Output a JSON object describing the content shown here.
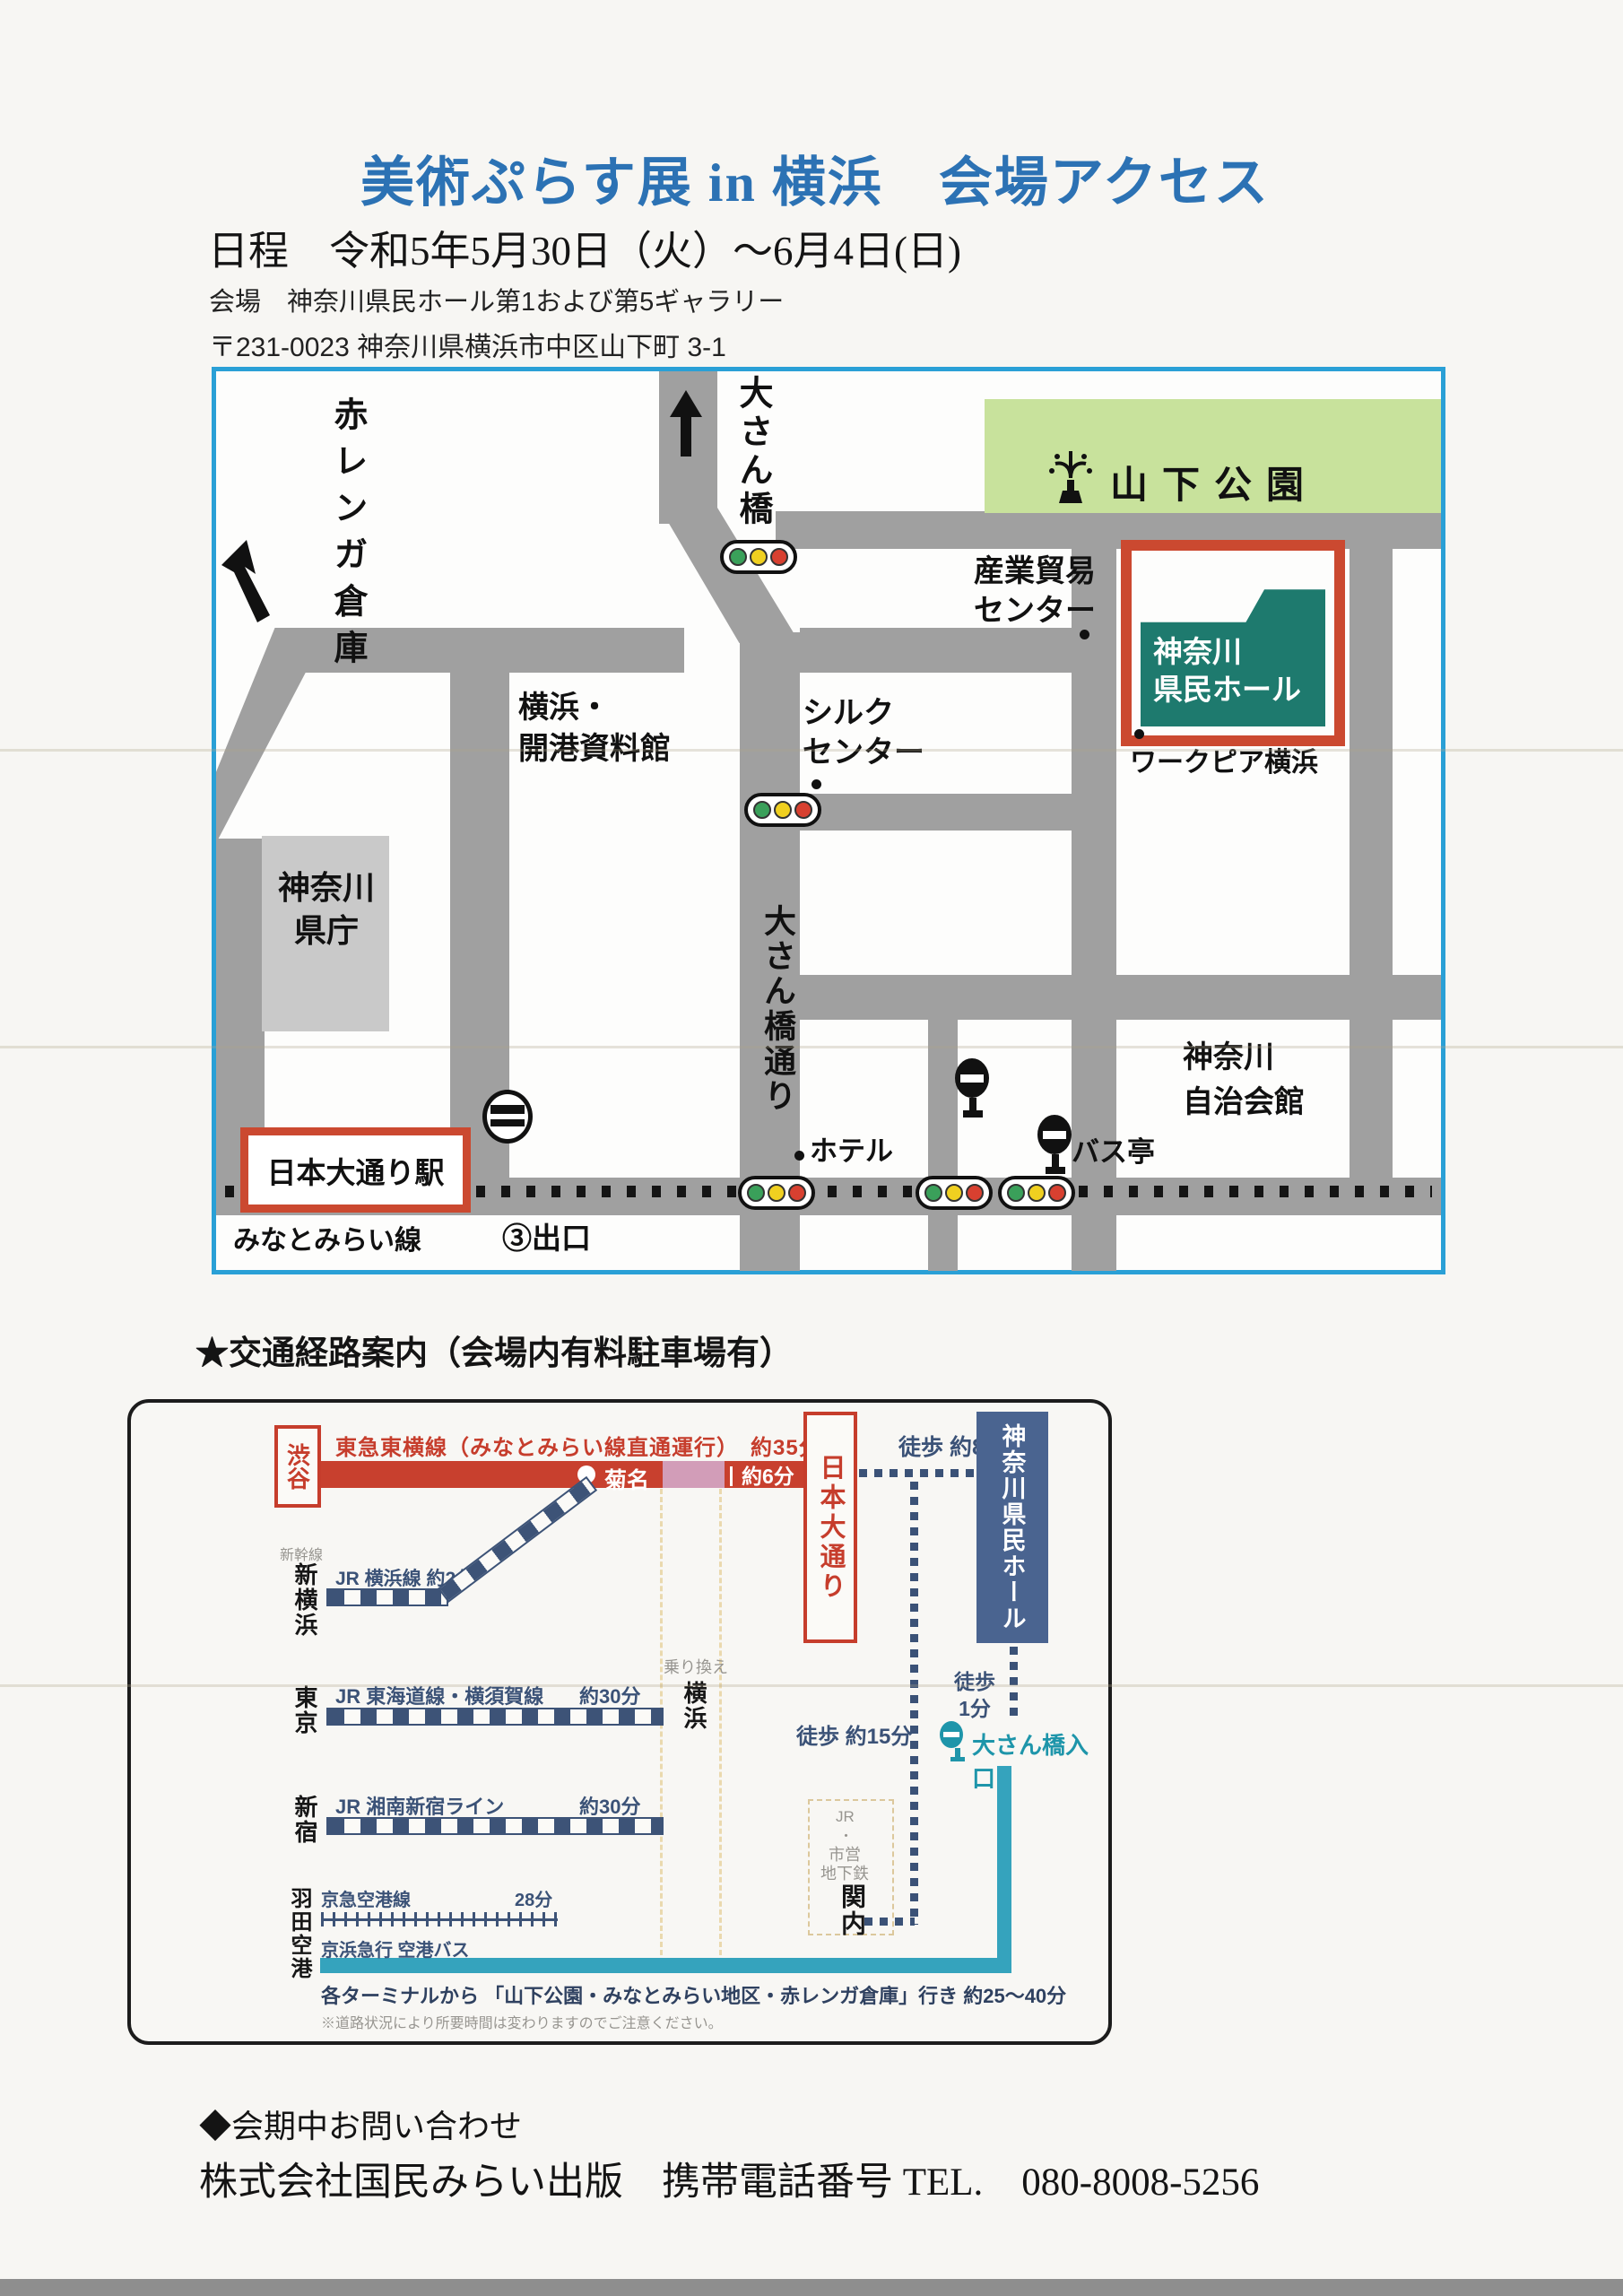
{
  "header": {
    "title": "美術ぷらす展 in 横浜　会場アクセス",
    "schedule": "日程　令和5年5月30日（火）～6月4日(日)",
    "venue": "会場　神奈川県民ホール第1および第5ギャラリー",
    "address": "〒231-0023 神奈川県横浜市中区山下町 3-1"
  },
  "map": {
    "akarenga": "赤レンガ倉庫",
    "osanbashi_pier": "大さん橋",
    "yamashita_park": "山下公園",
    "sangyo_boeki": "産業貿易\nセンター",
    "silk_center": "シルク\nセンター",
    "kaiko_museum": "横浜・\n開港資料館",
    "kenmin_hall": "神奈川\n県民ホール",
    "workpia": "ワークピア横浜",
    "kencho": "神奈川\n県庁",
    "osanbashi_dori": "大さん橋通り",
    "hotel": "ホテル",
    "jichikaikan": "神奈川\n自治会館",
    "bus_stop_label": "バス亭",
    "nihon_odori_station": "日本大通り駅",
    "minatomirai_line": "みなとみらい線",
    "exit3": "③出口"
  },
  "section": {
    "title": "★交通経路案内（会場内有料駐車場有）"
  },
  "transit": {
    "shibuya": "渋谷",
    "toyoko_label": "東急東横線（みなとみらい線直通運行）　約35分",
    "kikuna": "菊名",
    "about6": "約6分",
    "nihon_odori": "日本大通り",
    "walk8": "徒歩 約8分",
    "kenmin_hall": "神奈川県民ホール",
    "walk1": "徒歩\n1分",
    "osanbashi_entrance": "大さん橋入口",
    "walk15": "徒歩 約15分",
    "shinkansen": "新幹線",
    "shin_yokohama": "新横浜",
    "jr_yokohama_line": "JR 横浜線 約2分",
    "tokyo": "東京",
    "jr_tokaido": "JR 東海道線・横須賀線",
    "about30_a": "約30分",
    "shinjuku": "新宿",
    "jr_shonan": "JR 湘南新宿ライン",
    "about30_b": "約30分",
    "norikae": "乗り換え",
    "yokohama": "横浜",
    "kannai_jr": "JR",
    "kannai_dot": "・",
    "kannai_shiei": "市営",
    "kannai_chikatetsu": "地下鉄",
    "kannai": "関内",
    "haneda": "羽田空港",
    "keikyu_line": "京急空港線",
    "min28": "28分",
    "keihin_bus": "京浜急行 空港バス",
    "bus_note": "各ターミナルから 「山下公園・みなとみらい地区・赤レンガ倉庫」行き 約25～40分",
    "caution": "※道路状況により所要時間は変わりますのでご注意ください。"
  },
  "footer": {
    "inquiry": "◆会期中お問い合わせ",
    "contact": "株式会社国民みらい出版　携帯電話番号 TEL.　080-8008-5256"
  },
  "colors": {
    "title_blue": "#2c72b4",
    "map_border_blue": "#2aa0d6",
    "road_gray": "#a0a0a0",
    "park_green": "#c8e29c",
    "hall_teal": "#1e7a6e",
    "accent_red": "#c8402e",
    "line_pink": "#d29db8",
    "rail_navy": "#3d5377",
    "bus_teal": "#35a3bd"
  },
  "icons": {
    "traffic_light": "traffic-light-icon",
    "bus_stop": "bus-stop-icon",
    "metro_station": "metro-station-icon",
    "fountain": "fountain-icon",
    "arrow_up": "arrow-up-icon",
    "arrow_northwest": "arrow-northwest-icon"
  }
}
